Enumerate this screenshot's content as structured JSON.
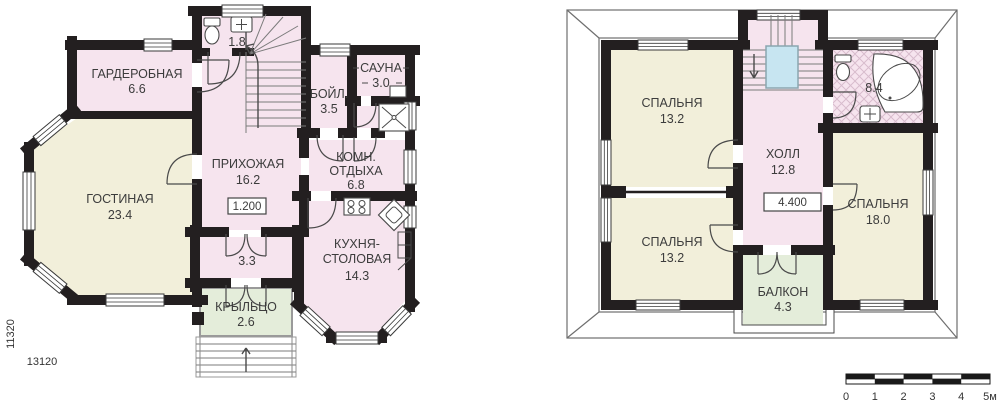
{
  "floor1": {
    "garderobnaya": {
      "name": "ГАРДЕРОБНАЯ",
      "area": "6.6"
    },
    "gostinaya": {
      "name": "ГОСТИНАЯ",
      "area": "23.4"
    },
    "prihozhaya": {
      "name": "ПРИХОЖАЯ",
      "area": "16.2"
    },
    "wc": {
      "area": "1.8"
    },
    "boylernaya": {
      "name": "БОЙЛ.",
      "area": "3.5"
    },
    "sauna": {
      "name": "САУНА",
      "area": "3.0"
    },
    "komnata_otdyha": {
      "name_line1": "КОМН.",
      "name_line2": "ОТДЫХА",
      "area": "6.8"
    },
    "kuhnya_stolovaya": {
      "name_line1": "КУХНЯ-",
      "name_line2": "СТОЛОВАЯ",
      "area": "14.3"
    },
    "tambur": {
      "area": "3.3"
    },
    "krylco": {
      "name": "КРЫЛЬЦО",
      "area": "2.6"
    },
    "elevation_mark": "1.200",
    "dim_horizontal": "13120",
    "dim_vertical": "11320"
  },
  "floor2": {
    "spalnya_top_left": {
      "name": "СПАЛЬНЯ",
      "area": "13.2"
    },
    "spalnya_bottom_left": {
      "name": "СПАЛЬНЯ",
      "area": "13.2"
    },
    "spalnya_right": {
      "name": "СПАЛЬНЯ",
      "area": "18.0"
    },
    "holl": {
      "name": "ХОЛЛ",
      "area": "12.8"
    },
    "sanuzel": {
      "area": "8.4"
    },
    "balkon": {
      "name": "БАЛКОН",
      "area": "4.3"
    },
    "elevation_mark": "4.400"
  },
  "scale_bar": {
    "labels": [
      "0",
      "1",
      "2",
      "3",
      "4",
      "5м"
    ]
  },
  "colors": {
    "wall": "#231f20",
    "room_cream": "#f2efda",
    "room_pink": "#f6e4ee",
    "room_green": "#e4edda",
    "stair_void_blue": "#c7e5f1",
    "hatch_line": "#d8bccd"
  }
}
